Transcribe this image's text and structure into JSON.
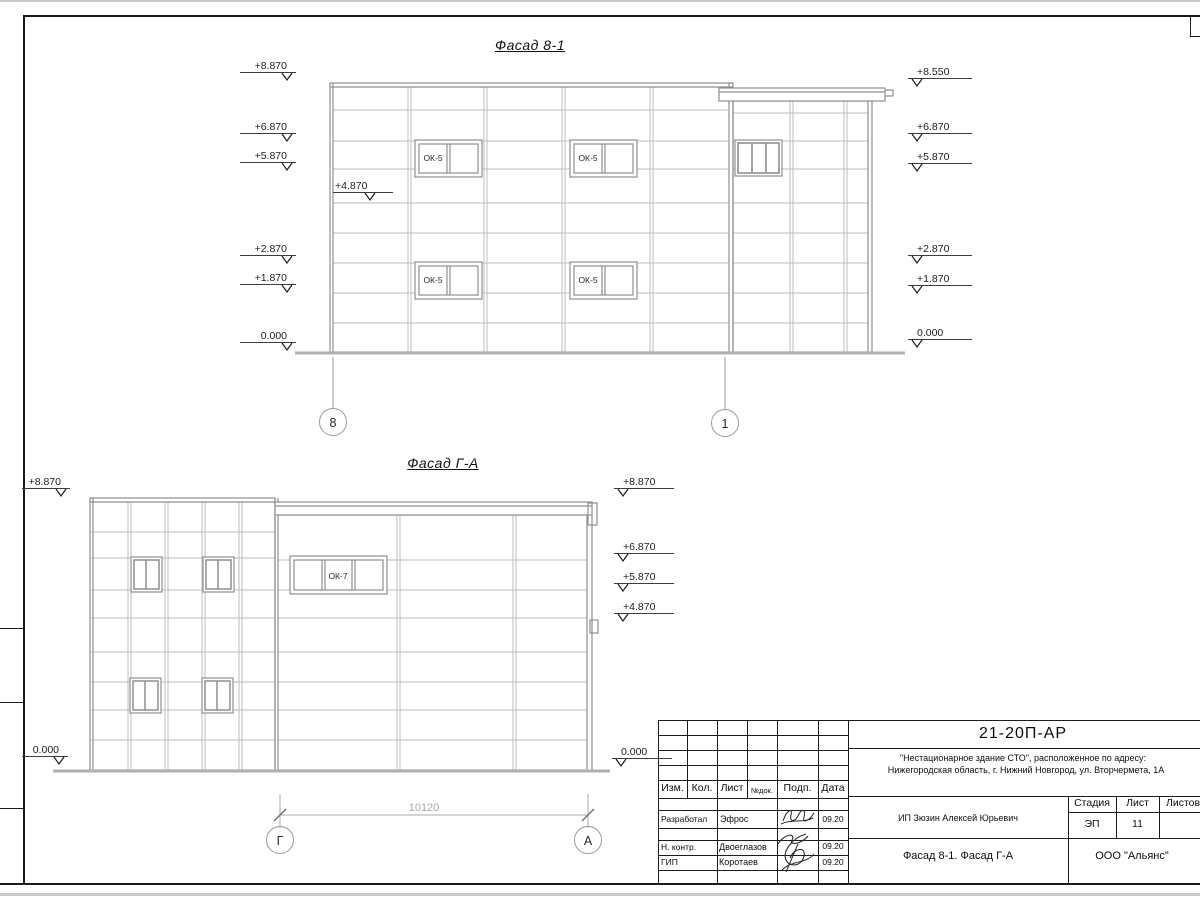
{
  "facade1": {
    "title": "Фасад 8-1",
    "left_marks": [
      "+8.870",
      "+6.870",
      "+5.870",
      "+2.870",
      "+1.870",
      "0.000"
    ],
    "inner_mark": "+4.870",
    "right_marks": [
      "+8.550",
      "+6.870",
      "+5.870",
      "+2.870",
      "+1.870",
      "0.000"
    ],
    "window_label": "ОК-5",
    "axis_left": "8",
    "axis_right": "1"
  },
  "facade2": {
    "title": "Фасад Г-А",
    "left_top_mark": "+8.870",
    "left_bottom_mark": "0.000",
    "right_marks": [
      "+8.870",
      "+6.870",
      "+5.870",
      "+4.870",
      "0.000"
    ],
    "window_label": "ОК-7",
    "dimension": "10120",
    "axis_left": "Г",
    "axis_right": "А"
  },
  "titleblock": {
    "code": "21-20П-АР",
    "object_line1": "\"Нестационарное здание СТО\", расположенное по адресу:",
    "object_line2": "Нижегородская область, г. Нижний Новгород, ул. Вторчермета, 1А",
    "client": "ИП Зюзин Алексей Юрьевич",
    "sheet_title": "Фасад 8-1. Фасад Г-А",
    "company": "ООО \"Альянс\"",
    "stage_label": "Стадия",
    "sheet_label": "Лист",
    "sheets_label": "Листов",
    "stage_value": "ЭП",
    "sheet_value": "11",
    "columns": [
      "Изм.",
      "Кол.",
      "Лист",
      "№док.",
      "Подп.",
      "Дата"
    ],
    "rows": [
      {
        "role": "Разработал",
        "name": "Эфрос",
        "date": "09.20"
      },
      {
        "role": "Н. контр.",
        "name": "Двоеглазов",
        "date": "09.20"
      },
      {
        "role": "ГИП",
        "name": "Коротаев",
        "date": "09.20"
      }
    ]
  }
}
